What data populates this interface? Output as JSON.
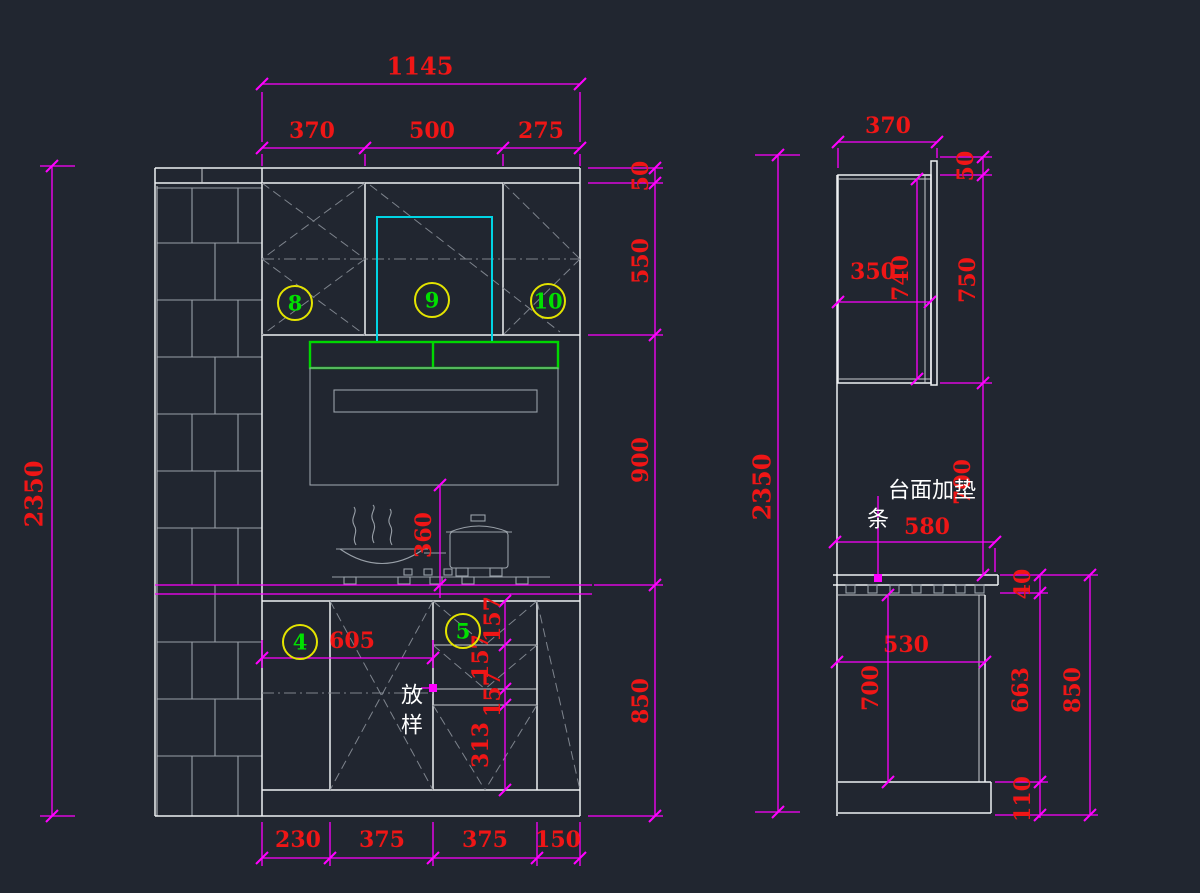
{
  "colors": {
    "background": "#212630",
    "outline": "#eef0f2",
    "dimension_line": "#ff00ff",
    "dimension_text": "#ef1616",
    "callout_circle": "#e4e400",
    "callout_number": "#00e000",
    "hood_band": "#00d800",
    "duct_outline": "#00d4e4"
  },
  "front": {
    "w_total": "1145",
    "w1": "370",
    "w2": "500",
    "w3": "275",
    "h1": "50",
    "h2": "550",
    "h3": "900",
    "h4": "850",
    "h_total": "2350",
    "hood_gap": "360",
    "offset": "605",
    "drawer1": "157",
    "drawer2": "157",
    "drawer3": "157",
    "door": "313",
    "b1": "230",
    "b2": "375",
    "b3": "375",
    "b4": "150",
    "c8": "8",
    "c9": "9",
    "c10": "10",
    "c4": "4",
    "c5": "5",
    "note1": "放",
    "note2": "样"
  },
  "side": {
    "h_total": "2350",
    "w_top": "370",
    "gap": "50",
    "depth_in": "350",
    "h_cab": "740",
    "h_front": "750",
    "clear": "700",
    "counter_depth": "580",
    "counter_thk": "40",
    "base_depth": "530",
    "base_h": "700",
    "h_leg": "663",
    "h_base_total": "850",
    "toe": "110",
    "pad1": "台面加垫",
    "pad2": "条"
  }
}
